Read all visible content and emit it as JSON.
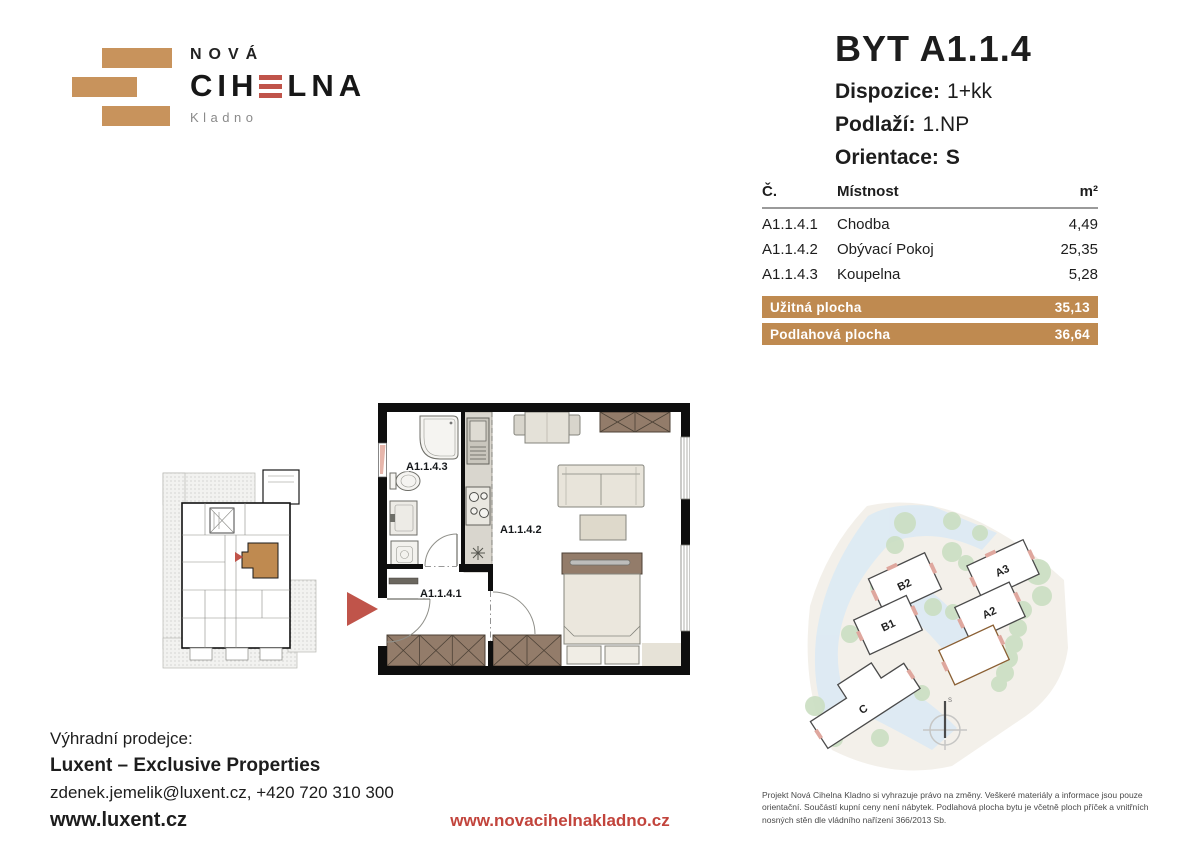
{
  "colors": {
    "brick": "#c8935c",
    "accent_red": "#c0544a",
    "link_red": "#c2443c",
    "table_highlight": "#bf8a50",
    "wood": "#937c6a",
    "tree_green": "#cbdfc3",
    "road_blue": "#dceaf4"
  },
  "logo": {
    "line1": "NOVÁ",
    "name_pre": "CIH",
    "name_post": "LNA",
    "subtitle": "Kladno"
  },
  "unit": {
    "title": "BYT A1.1.4",
    "attributes": [
      {
        "label": "Dispozice:",
        "value": "1+kk"
      },
      {
        "label": "Podlaží:",
        "value": "1.NP"
      },
      {
        "label": "Orientace:",
        "value": "S"
      }
    ]
  },
  "room_table": {
    "col_number": "Č.",
    "col_room": "Místnost",
    "col_area": "m²",
    "rows": [
      {
        "number": "A1.1.4.1",
        "room": "Chodba",
        "area": "4,49"
      },
      {
        "number": "A1.1.4.2",
        "room": "Obývací Pokoj",
        "area": "25,35"
      },
      {
        "number": "A1.1.4.3",
        "room": "Koupelna",
        "area": "5,28"
      }
    ],
    "totals": [
      {
        "label": "Užitná plocha",
        "value": "35,13"
      },
      {
        "label": "Podlahová plocha",
        "value": "36,64"
      }
    ]
  },
  "floorplan": {
    "label_hall": "A1.1.4.1",
    "label_living": "A1.1.4.2",
    "label_bath": "A1.1.4.3"
  },
  "siteplan": {
    "buildings": [
      {
        "id": "B2"
      },
      {
        "id": "B1"
      },
      {
        "id": "A3"
      },
      {
        "id": "A2"
      },
      {
        "id": "A1",
        "highlighted": true
      },
      {
        "id": "C"
      }
    ],
    "compass": "S"
  },
  "footer": {
    "seller_label": "Výhradní prodejce:",
    "seller_name": "Luxent – Exclusive Properties",
    "seller_contact": "zdenek.jemelik@luxent.cz, +420 720 310 300",
    "seller_web": "www.luxent.cz",
    "project_web": "www.novacihelnakladno.cz",
    "disclaimer": "Projekt Nová Cihelna Kladno si vyhrazuje právo na změny. Veškeré materiály a informace jsou pouze orientační. Součástí kupní ceny není nábytek. Podlahová plocha bytu je včetně ploch příček a vnitřních nosných stěn dle vládního nařízení 366/2013 Sb."
  }
}
